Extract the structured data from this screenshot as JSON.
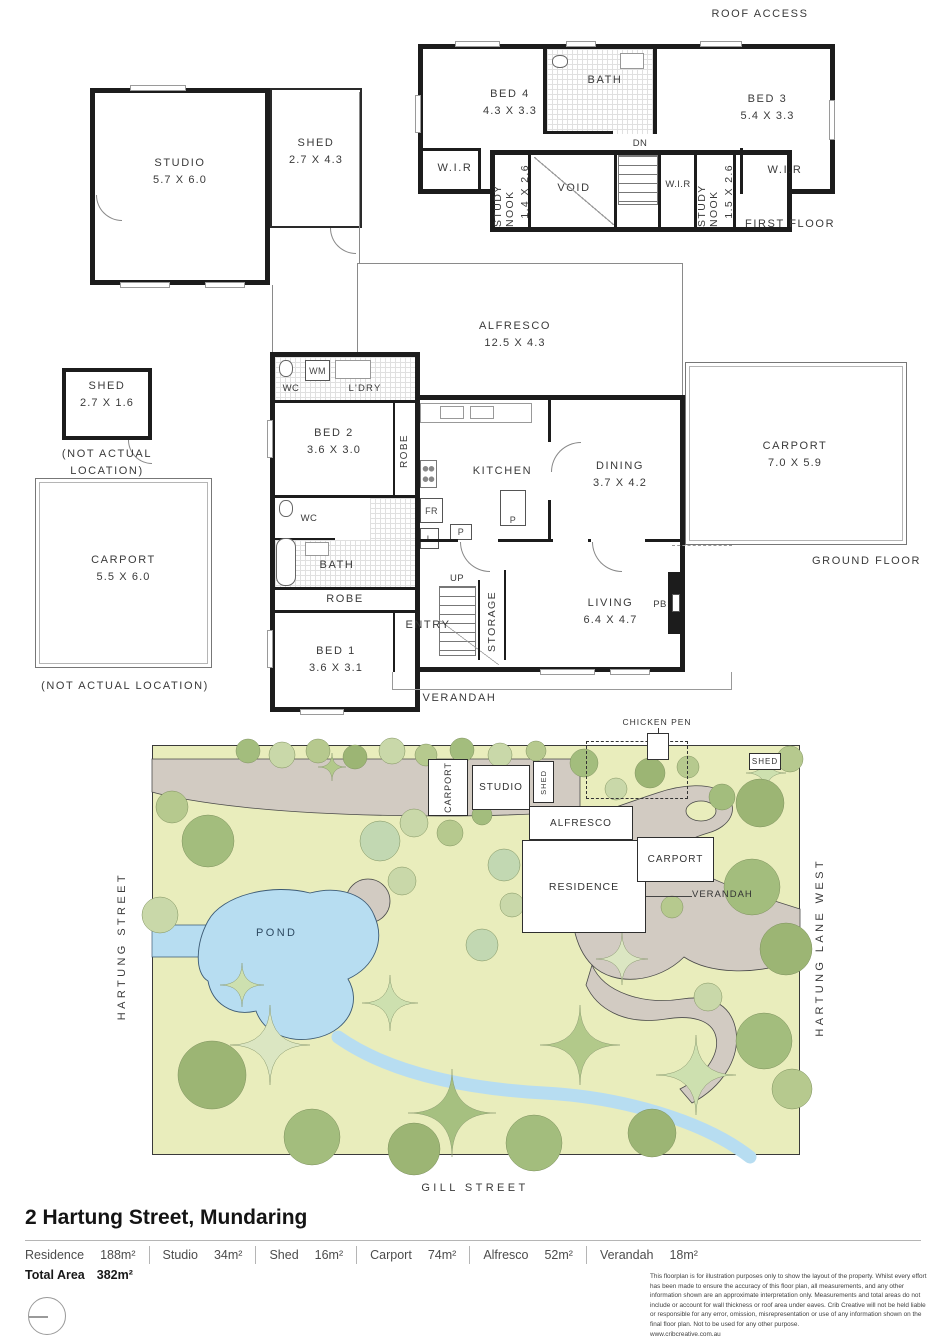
{
  "first_floor": {
    "roof_access": "ROOF ACCESS",
    "floor_label": "FIRST FLOOR",
    "bed4_name": "BED 4",
    "bed4_dims": "4.3 X 3.3",
    "bath": "BATH",
    "bed3_name": "BED 3",
    "bed3_dims": "5.4 X 3.3",
    "wir_left": "W.I.R",
    "study_nook_left_name": "STUDY NOOK",
    "study_nook_left_dims": "1.4 X 2.6",
    "void": "VOID",
    "dn": "DN",
    "wir_mid": "W.I.R",
    "study_nook_right_name": "STUDY NOOK",
    "study_nook_right_dims": "1.5 X 2.6",
    "wir_right": "W.I.R"
  },
  "outbuildings": {
    "studio_name": "STUDIO",
    "studio_dims": "5.7 X 6.0",
    "shed_attached_name": "SHED",
    "shed_attached_dims": "2.7 X 4.3",
    "shed_small_name": "SHED",
    "shed_small_dims": "2.7 X 1.6",
    "shed_small_note": "(NOT ACTUAL LOCATION)",
    "carport_left_name": "CARPORT",
    "carport_left_dims": "5.5 X 6.0",
    "carport_left_note": "(NOT ACTUAL LOCATION)"
  },
  "ground_floor": {
    "floor_label": "GROUND FLOOR",
    "alfresco_name": "ALFRESCO",
    "alfresco_dims": "12.5 X 4.3",
    "wc_top": "WC",
    "wm": "WM",
    "ldry": "L'DRY",
    "bed2_name": "BED 2",
    "bed2_dims": "3.6 X 3.0",
    "robe_top": "ROBE",
    "kitchen": "KITCHEN",
    "fr": "FR",
    "l": "L",
    "p1": "P",
    "p2": "P",
    "dining_name": "DINING",
    "dining_dims": "3.7 X 4.2",
    "carport_name": "CARPORT",
    "carport_dims": "7.0 X 5.9",
    "wc_mid": "WC",
    "bath": "BATH",
    "robe_bottom": "ROBE",
    "bed1_name": "BED 1",
    "bed1_dims": "3.6 X 3.1",
    "entry": "ENTRY",
    "up": "UP",
    "storage": "STORAGE",
    "living_name": "LIVING",
    "living_dims": "6.4 X 4.7",
    "pb": "PB",
    "verandah": "VERANDAH"
  },
  "site_plan": {
    "street_left": "HARTUNG STREET",
    "street_right": "HARTUNG LANE WEST",
    "street_bottom": "GILL STREET",
    "chicken_pen": "CHICKEN PEN",
    "shed_ne": "SHED",
    "carport_w": "CARPORT",
    "studio": "STUDIO",
    "shed_mid": "SHED",
    "alfresco": "ALFRESCO",
    "residence": "RESIDENCE",
    "carport_e": "CARPORT",
    "verandah": "VERANDAH",
    "pond": "POND"
  },
  "footer": {
    "address": "2 Hartung Street, Mundaring",
    "areas": [
      {
        "label": "Residence",
        "value": "188m²"
      },
      {
        "label": "Studio",
        "value": "34m²"
      },
      {
        "label": "Shed",
        "value": "16m²"
      },
      {
        "label": "Carport",
        "value": "74m²"
      },
      {
        "label": "Alfresco",
        "value": "52m²"
      },
      {
        "label": "Verandah",
        "value": "18m²"
      }
    ],
    "total_label": "Total Area",
    "total_value": "382m²",
    "disclaimer": "This floorplan is for illustration purposes only to show the layout of the property. Whilst every effort has been made to ensure the accuracy of this floor plan, all measurements, and any other information shown are an approximate interpretation only. Measurements and total areas do not include or account for wall thickness or roof area under eaves. Crib Creative will not be held liable or responsible for any error, omission, misrepresentation or use of any information shown on the final floor plan. Not to be used for any other purpose.",
    "website": "www.cribcreative.com.au"
  },
  "colors": {
    "wall": "#1c1c1c",
    "site_background": "#e9edbc",
    "pond": "#b7ddf1",
    "driveway": "#d2cbc2",
    "tree_green": "#a3bd7d",
    "tree_light": "#c9d8a9"
  }
}
